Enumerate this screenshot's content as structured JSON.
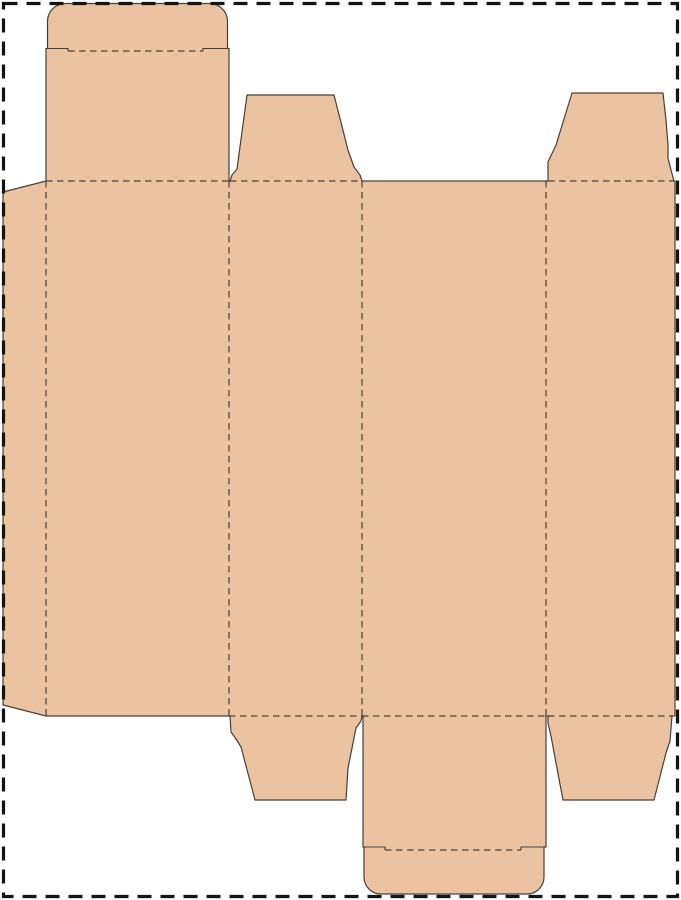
{
  "diagram": {
    "type": "packaging-dieline",
    "description": "Flat die-cut template (dieline) for a tuck-end carton box: glue flap, four panels, tuck flaps with rounded tuck tabs, and trapezoid dust flaps. Solid lines are cuts, dashed lines are folds.",
    "canvas": {
      "width": 681,
      "height": 900,
      "background": "#ffffff"
    },
    "colors": {
      "board_fill": "#ebc3a1",
      "cut_line": "#46403a",
      "fold_line": "#46403a",
      "page_border": "#141414"
    },
    "fold_style": {
      "width": 1.2,
      "dash": "6.5 4.5"
    },
    "cut_style": {
      "width": 1.2
    },
    "slit_style": {
      "width": 1.1
    },
    "page_border": {
      "x": 3.5,
      "y": 3.5,
      "width": 674,
      "height": 893,
      "stroke_width": 3.2,
      "dash": "14 9"
    },
    "regions": [
      {
        "name": "glue-flap",
        "path": "M 3 192 L 46 181 L 46 716 L 3 705 Z"
      },
      {
        "name": "panel-1",
        "path": "M 46 181 L 229 181 L 229 716 L 46 716 Z"
      },
      {
        "name": "panel-2",
        "path": "M 229 181 L 362 181 L 362 716 L 229 716 Z"
      },
      {
        "name": "panel-3",
        "path": "M 362 181 L 546 181 L 546 716 L 362 716 Z"
      },
      {
        "name": "panel-4",
        "path": "M 546 181 L 675 181 L 675 716 L 546 716 Z"
      },
      {
        "name": "tuck-flap-top",
        "path": "M 46 48.5 L 229 48.5 L 229 181 L 46 181 Z"
      },
      {
        "name": "tuck-tab-top",
        "path": "M 47.5 51 L 47.5 21 A 18 18 0 0 1 65.5 3.5 L 209.5 3.5 A 18 18 0 0 1 227.5 21 L 227.5 51 Z"
      },
      {
        "name": "dust-flap-top-left",
        "path": "M 230 181 L 232 175 L 237 169 L 247 95 L 334 95 L 348 150 L 354 167 L 360 175 L 362 181 Z"
      },
      {
        "name": "dust-flap-top-right",
        "path": "M 548 181 L 548 162 L 556 145 L 572 93 L 663 93 L 666 120 L 668 145 L 668 158 L 671 170 L 674 181 Z"
      },
      {
        "name": "tuck-flap-bottom",
        "path": "M 363 716 L 546 716 L 546 847 L 363 847 Z"
      },
      {
        "name": "tuck-tab-bottom",
        "path": "M 364 847 L 544 847 L 544 877 A 17 17 0 0 1 527 894 L 381 894 A 17 17 0 0 1 364 877 Z"
      },
      {
        "name": "dust-flap-bottom-left",
        "path": "M 230 716 L 362 716 L 361 721 L 356 728 L 348 768 L 346 800 L 255 800 L 241 747 L 236 739 L 231 732 Z"
      },
      {
        "name": "dust-flap-bottom-right",
        "path": "M 548 716 L 672 716 L 670 741 L 666 753 L 654 800 L 563 800 L 559 779 L 551 736 L 548 723 Z"
      }
    ],
    "cut_outline": {
      "name": "cut-outline",
      "path": "M 3 192 L 46 181 L 46 48.5 L 47.5 48.5 L 47.5 21 A 18 18 0 0 1 65.5 3.5 L 209.5 3.5 A 18 18 0 0 1 227.5 21 L 227.5 48.5 L 229 48.5 L 229 181 L 230 181 L 232 175 L 237 169 L 247 95 L 334 95 L 348 150 L 354 167 L 360 175 L 362 181 L 546 181 L 548 181 L 548 162 L 556 145 L 572 93 L 663 93 L 666 120 L 668 145 L 668 158 L 671 170 L 674 181 L 675 181 L 675 716 L 672 716 L 670 741 L 666 753 L 654 800 L 563 800 L 559 779 L 551 736 L 548 723 L 548 716 L 546 716 L 546 847 L 544 847 L 544 877 A 17 17 0 0 1 527 894 L 381 894 A 17 17 0 0 1 364 877 L 364 847 L 363 847 L 363 716 L 362 716 L 361 721 L 356 728 L 348 768 L 346 800 L 255 800 L 241 747 L 236 739 L 231 732 L 230 716 L 229 716 L 46 716 L 3 705 Z"
    },
    "fold_lines": [
      {
        "name": "fold-top-panel-1",
        "x1": 46,
        "y1": 181,
        "x2": 229,
        "y2": 181
      },
      {
        "name": "fold-top-panel-2",
        "x1": 230,
        "y1": 181,
        "x2": 362,
        "y2": 181
      },
      {
        "name": "fold-top-panel-4",
        "x1": 548,
        "y1": 181,
        "x2": 674,
        "y2": 181
      },
      {
        "name": "fold-bottom-panel-2",
        "x1": 229,
        "y1": 716,
        "x2": 362,
        "y2": 716
      },
      {
        "name": "fold-bottom-panel-3",
        "x1": 362,
        "y1": 716,
        "x2": 546,
        "y2": 716
      },
      {
        "name": "fold-bottom-panel-4",
        "x1": 548,
        "y1": 716,
        "x2": 672,
        "y2": 716
      },
      {
        "name": "fold-glue-flap",
        "x1": 46,
        "y1": 181,
        "x2": 46,
        "y2": 716
      },
      {
        "name": "fold-panel-1-2",
        "x1": 229,
        "y1": 181,
        "x2": 229,
        "y2": 716
      },
      {
        "name": "fold-panel-2-3",
        "x1": 362,
        "y1": 181,
        "x2": 362,
        "y2": 716
      },
      {
        "name": "fold-panel-3-4",
        "x1": 546,
        "y1": 181,
        "x2": 546,
        "y2": 716
      },
      {
        "name": "fold-tuck-tab-top",
        "x1": 68,
        "y1": 51,
        "x2": 203,
        "y2": 51
      },
      {
        "name": "fold-tuck-tab-bottom",
        "x1": 385,
        "y1": 850,
        "x2": 521,
        "y2": 850
      }
    ],
    "slits": [
      {
        "name": "slit-tab-top-left",
        "path": "M 47.5 48.5 L 68 48.5 L 68 51"
      },
      {
        "name": "slit-tab-top-right",
        "path": "M 227.5 48.5 L 203 48.5 L 203 51"
      },
      {
        "name": "slit-tab-bottom-left",
        "path": "M 363 847 L 385 847 L 385 850"
      },
      {
        "name": "slit-tab-bottom-right",
        "path": "M 546 847 L 521 847 L 521 850"
      }
    ]
  }
}
